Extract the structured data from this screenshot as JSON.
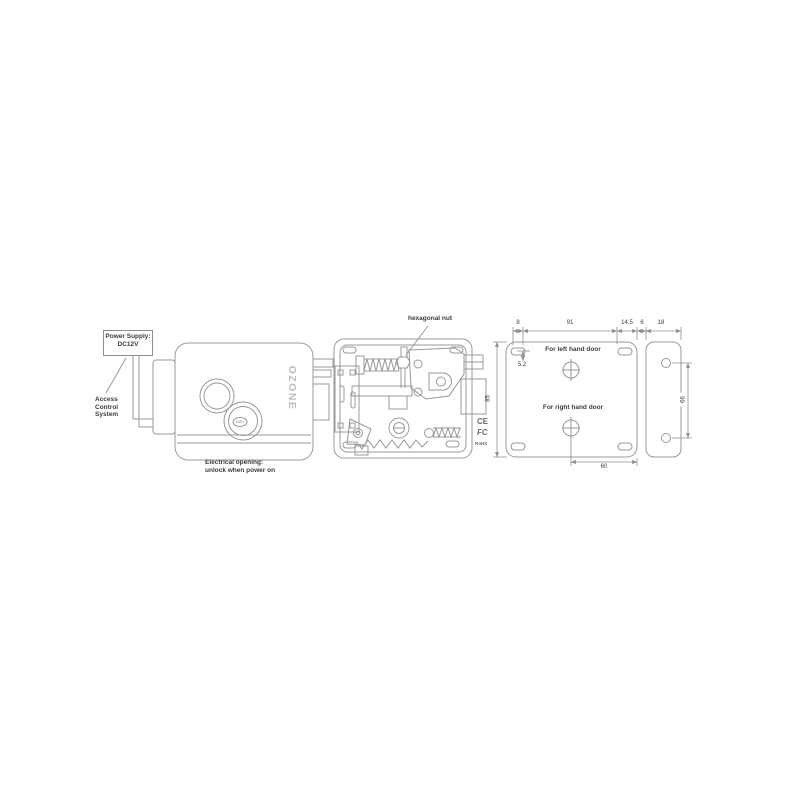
{
  "colors": {
    "line": "#989898",
    "text": "#3c3c3c",
    "brand": "#bdbdbd"
  },
  "front_view": {
    "power_supply_line1": "Power Supply:",
    "power_supply_line2": "DC12V",
    "access_line1": "Access",
    "access_line2": "Control",
    "access_line3": "System",
    "brand_logo": "OZONE",
    "knob_label": "turn",
    "note_line1": "Electrical opening:",
    "note_line2": "unlock when power on"
  },
  "internal_view": {
    "hex_nut_callout": "hexagonal nut",
    "ce_mark": "CE",
    "fcc_mark": "FC",
    "rohs_mark": "RoHS"
  },
  "plate_view": {
    "left_door_label": "For left hand door",
    "right_door_label": "For right hand door",
    "dim_edge_to_slot": "8",
    "dim_slot_spacing": "91",
    "dim_slot_to_edge": "14.5",
    "dim_gap": "6",
    "dim_strike_width": "18",
    "dim_slot_offset": "5.2",
    "dim_plate_height": "85",
    "dim_screw_to_edge": "60",
    "dim_strike_holes": "66"
  }
}
